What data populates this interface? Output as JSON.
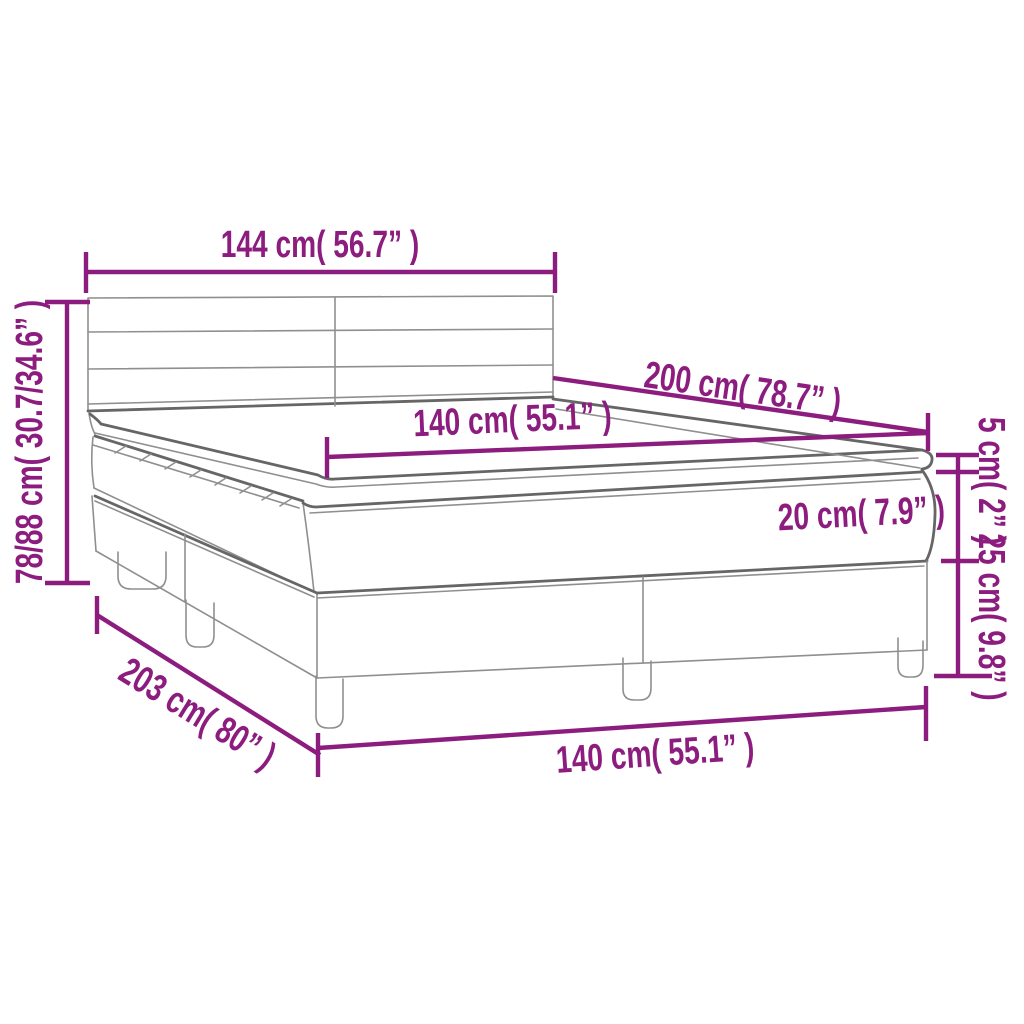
{
  "accent_color": "#8C1D7F",
  "line_color": "#8f8f8f",
  "background_color": "#ffffff",
  "diagram": {
    "type": "product-dimension-diagram",
    "subject": "box spring bed with headboard, mattress and topper",
    "labels": {
      "headboard_width": "144 cm( 56.7” )",
      "overall_height": "78/88 cm( 30.7/34.6” )",
      "bed_length": "200 cm( 78.7” )",
      "mattress_width": "140 cm( 55.1” )",
      "topper_thickness": "5 cm( 2” )",
      "mattress_thickness": "20 cm( 7.9” )",
      "base_height": "25 cm( 9.8” )",
      "base_length": "203 cm( 80” )",
      "base_width": "140 cm( 55.1” )"
    }
  }
}
